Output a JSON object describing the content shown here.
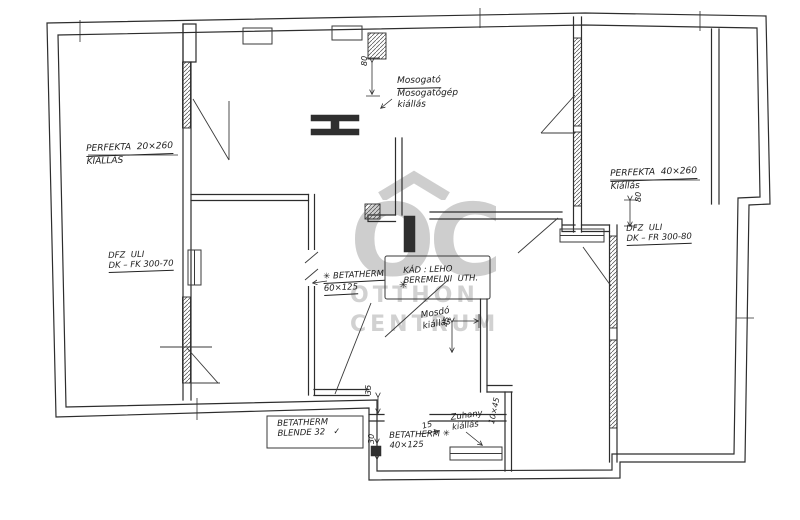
{
  "watermark": {
    "initials": "OC",
    "line1": "OTTHON",
    "line2": "CENTRUM",
    "color": "#c6c6c6",
    "roof_icon": "house-roof-chevron"
  },
  "drawing": {
    "ink_color": "#2d2d2d",
    "paper_color": "#ffffff"
  },
  "annotations": [
    {
      "name": "note-perfekta-left",
      "x": 86,
      "y": 144,
      "rot": -2,
      "size": 9,
      "lines": [
        {
          "t": "PERFEKTA  20×260",
          "u": true
        },
        {
          "t": "KIÁLLÁS",
          "u": false
        }
      ]
    },
    {
      "name": "note-mosogato",
      "x": 397,
      "y": 76,
      "rot": -1,
      "size": 9,
      "lines": [
        {
          "t": "Mosogató",
          "u": true
        },
        {
          "t": "Mosogatógép",
          "u": false
        },
        {
          "t": "kiállás",
          "u": false
        }
      ]
    },
    {
      "name": "note-perfekta-right",
      "x": 610,
      "y": 169,
      "rot": -2,
      "size": 9,
      "lines": [
        {
          "t": "PERFEKTA  40×260",
          "u": true
        },
        {
          "t": "Kiállás",
          "u": false
        }
      ]
    },
    {
      "name": "note-dfz-left",
      "x": 108,
      "y": 251,
      "rot": -2,
      "size": 8.5,
      "lines": [
        {
          "t": "DFZ  ULI",
          "u": false
        },
        {
          "t": "DK – FK 300-70",
          "u": true
        }
      ]
    },
    {
      "name": "note-dfz-right",
      "x": 626,
      "y": 224,
      "rot": -2,
      "size": 8.5,
      "lines": [
        {
          "t": "DFZ  ULI",
          "u": false
        },
        {
          "t": "DK – FR 300-80",
          "u": true
        }
      ]
    },
    {
      "name": "note-betatherm-middle",
      "x": 323,
      "y": 272,
      "rot": -3,
      "size": 8.5,
      "lines": [
        {
          "t": "✳ BETATHERM",
          "u": true
        },
        {
          "t": "60×125",
          "u": true
        }
      ]
    },
    {
      "name": "note-kad",
      "x": 403,
      "y": 266,
      "rot": -2,
      "size": 8.5,
      "lines": [
        {
          "t": "KÁD : LEHO",
          "u": false
        },
        {
          "t": "BEREMELNI  UTH.",
          "u": false
        }
      ]
    },
    {
      "name": "note-mosdo",
      "x": 420,
      "y": 311,
      "rot": -10,
      "size": 9,
      "lines": [
        {
          "t": "Mosdó",
          "u": false
        },
        {
          "t": "kiállás",
          "u": false
        }
      ]
    },
    {
      "name": "note-betatherm-blende",
      "x": 277,
      "y": 419,
      "rot": -2,
      "size": 8.5,
      "lines": [
        {
          "t": "BETATHERM",
          "u": false
        },
        {
          "t": "BLENDE 32   ✓",
          "u": false
        }
      ]
    },
    {
      "name": "note-betatherm-bottom",
      "x": 389,
      "y": 431,
      "rot": -2,
      "size": 8.5,
      "lines": [
        {
          "t": "BETATHERM ✳",
          "u": false
        },
        {
          "t": "40×125",
          "u": false
        }
      ]
    },
    {
      "name": "note-zuhany",
      "x": 450,
      "y": 413,
      "rot": -8,
      "size": 8.5,
      "lines": [
        {
          "t": "Zuhany",
          "u": false
        },
        {
          "t": "kiállás",
          "u": false
        }
      ]
    },
    {
      "name": "dim-80-top",
      "x": 360,
      "y": 66,
      "rot": -90,
      "size": 8,
      "lines": [
        {
          "t": "80",
          "u": false
        }
      ]
    },
    {
      "name": "dim-80-right",
      "x": 634,
      "y": 202,
      "rot": -90,
      "size": 8,
      "lines": [
        {
          "t": "80",
          "u": false
        }
      ]
    },
    {
      "name": "dim-45",
      "x": 441,
      "y": 326,
      "rot": -80,
      "size": 8,
      "lines": [
        {
          "t": "45",
          "u": false
        }
      ]
    },
    {
      "name": "dim-35",
      "x": 364,
      "y": 395,
      "rot": -90,
      "size": 8,
      "lines": [
        {
          "t": "35",
          "u": false
        }
      ]
    },
    {
      "name": "dim-30",
      "x": 367,
      "y": 444,
      "rot": -90,
      "size": 8,
      "lines": [
        {
          "t": "30",
          "u": false
        }
      ]
    },
    {
      "name": "dim-15",
      "x": 421,
      "y": 422,
      "rot": -15,
      "size": 8,
      "lines": [
        {
          "t": "15",
          "u": false
        }
      ]
    },
    {
      "name": "dim-10x45",
      "x": 487,
      "y": 423,
      "rot": -78,
      "size": 8,
      "lines": [
        {
          "t": "10×45",
          "u": false
        }
      ]
    },
    {
      "name": "symbol-star",
      "x": 399,
      "y": 280,
      "rot": 0,
      "size": 10,
      "lines": [
        {
          "t": "✳",
          "u": false
        }
      ]
    }
  ]
}
